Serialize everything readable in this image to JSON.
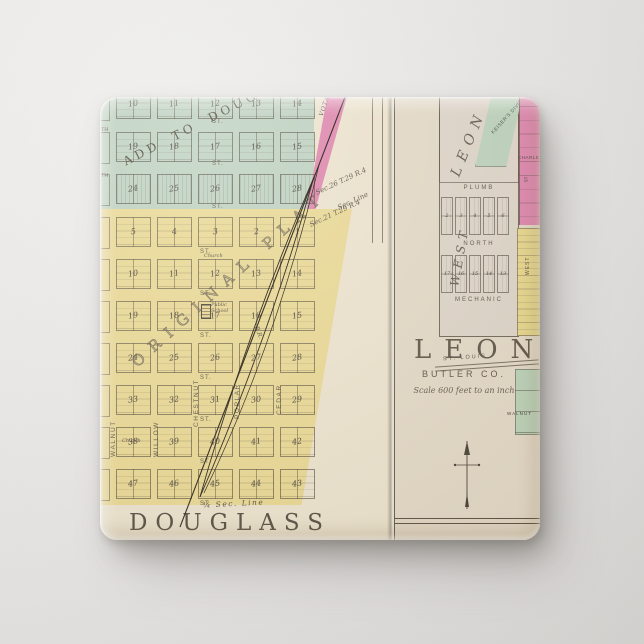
{
  "scene": {
    "description": "Square pinback button printed with a vintage county atlas plat map of Douglass and Leon, Butler County, Kansas"
  },
  "button_map": {
    "left_panel": {
      "title": "DOUGLASS",
      "add_label": "ADD TO DOUGLASS",
      "plat_label": "ORIGINAL PLAT",
      "vota_label": "VOTA'S ADD",
      "church_label": "Church",
      "school_label": "Public School",
      "railroad_label": "R.R.",
      "sec_note_1": "Sec.26 T.29 R.4",
      "sec_note_2": "Sec. Line",
      "sec_note_3": "Sec.21 T.29 R.4",
      "quarter_sec_label": "¼ Sec. Line",
      "street_label": "ST.",
      "street_fragment": "TH",
      "v_streets": [
        "WALNUT",
        "WILLOW",
        "CHESTNUT",
        "POPLAR",
        "CEDAR"
      ],
      "add_rows": [
        [
          "10",
          "11",
          "12",
          "13",
          "14"
        ],
        [
          "19",
          "18",
          "17",
          "16",
          "15"
        ],
        [
          "24",
          "25",
          "26",
          "27",
          "28"
        ]
      ],
      "plat_rows": [
        [
          "5",
          "4",
          "3",
          "2",
          "1"
        ],
        [
          "10",
          "11",
          "12",
          "13",
          "14"
        ],
        [
          "19",
          "18",
          "17",
          "16",
          "15"
        ],
        [
          "24",
          "25",
          "26",
          "27",
          "28"
        ],
        [
          "33",
          "32",
          "31",
          "30",
          "29"
        ],
        [
          "38",
          "39",
          "40",
          "41",
          "42"
        ],
        [
          "47",
          "46",
          "45",
          "44",
          "43"
        ]
      ]
    },
    "right_panel": {
      "title": "LEON",
      "subtitle": "BUTLER CO.",
      "scale_note": "Scale 600 feet to an inch",
      "big_name": "LEON",
      "west_label": "WEST",
      "division_label": "KEISER'S DIVISION",
      "charles_label": "CHARLES",
      "st_label": "ST",
      "streets": {
        "plumb": "PLUMB",
        "north": "NORTH",
        "mechanic": "MECHANIC",
        "st_louis": "ST. LOUIS",
        "walnut": "WALNUT"
      },
      "plat_rows": [
        [
          "2",
          "3",
          "4",
          "5",
          "6"
        ],
        [
          "17",
          "16",
          "15",
          "14",
          "13"
        ]
      ]
    },
    "colors": {
      "paper": "#ece2ca",
      "right_paper": "#e3d7c2",
      "addition_green": "#b9cebb",
      "plat_yellow": "#e9d68c",
      "addition_pink": "#de7ea8",
      "ink": "#46402f",
      "background_wall": "#e9e7e5"
    }
  }
}
